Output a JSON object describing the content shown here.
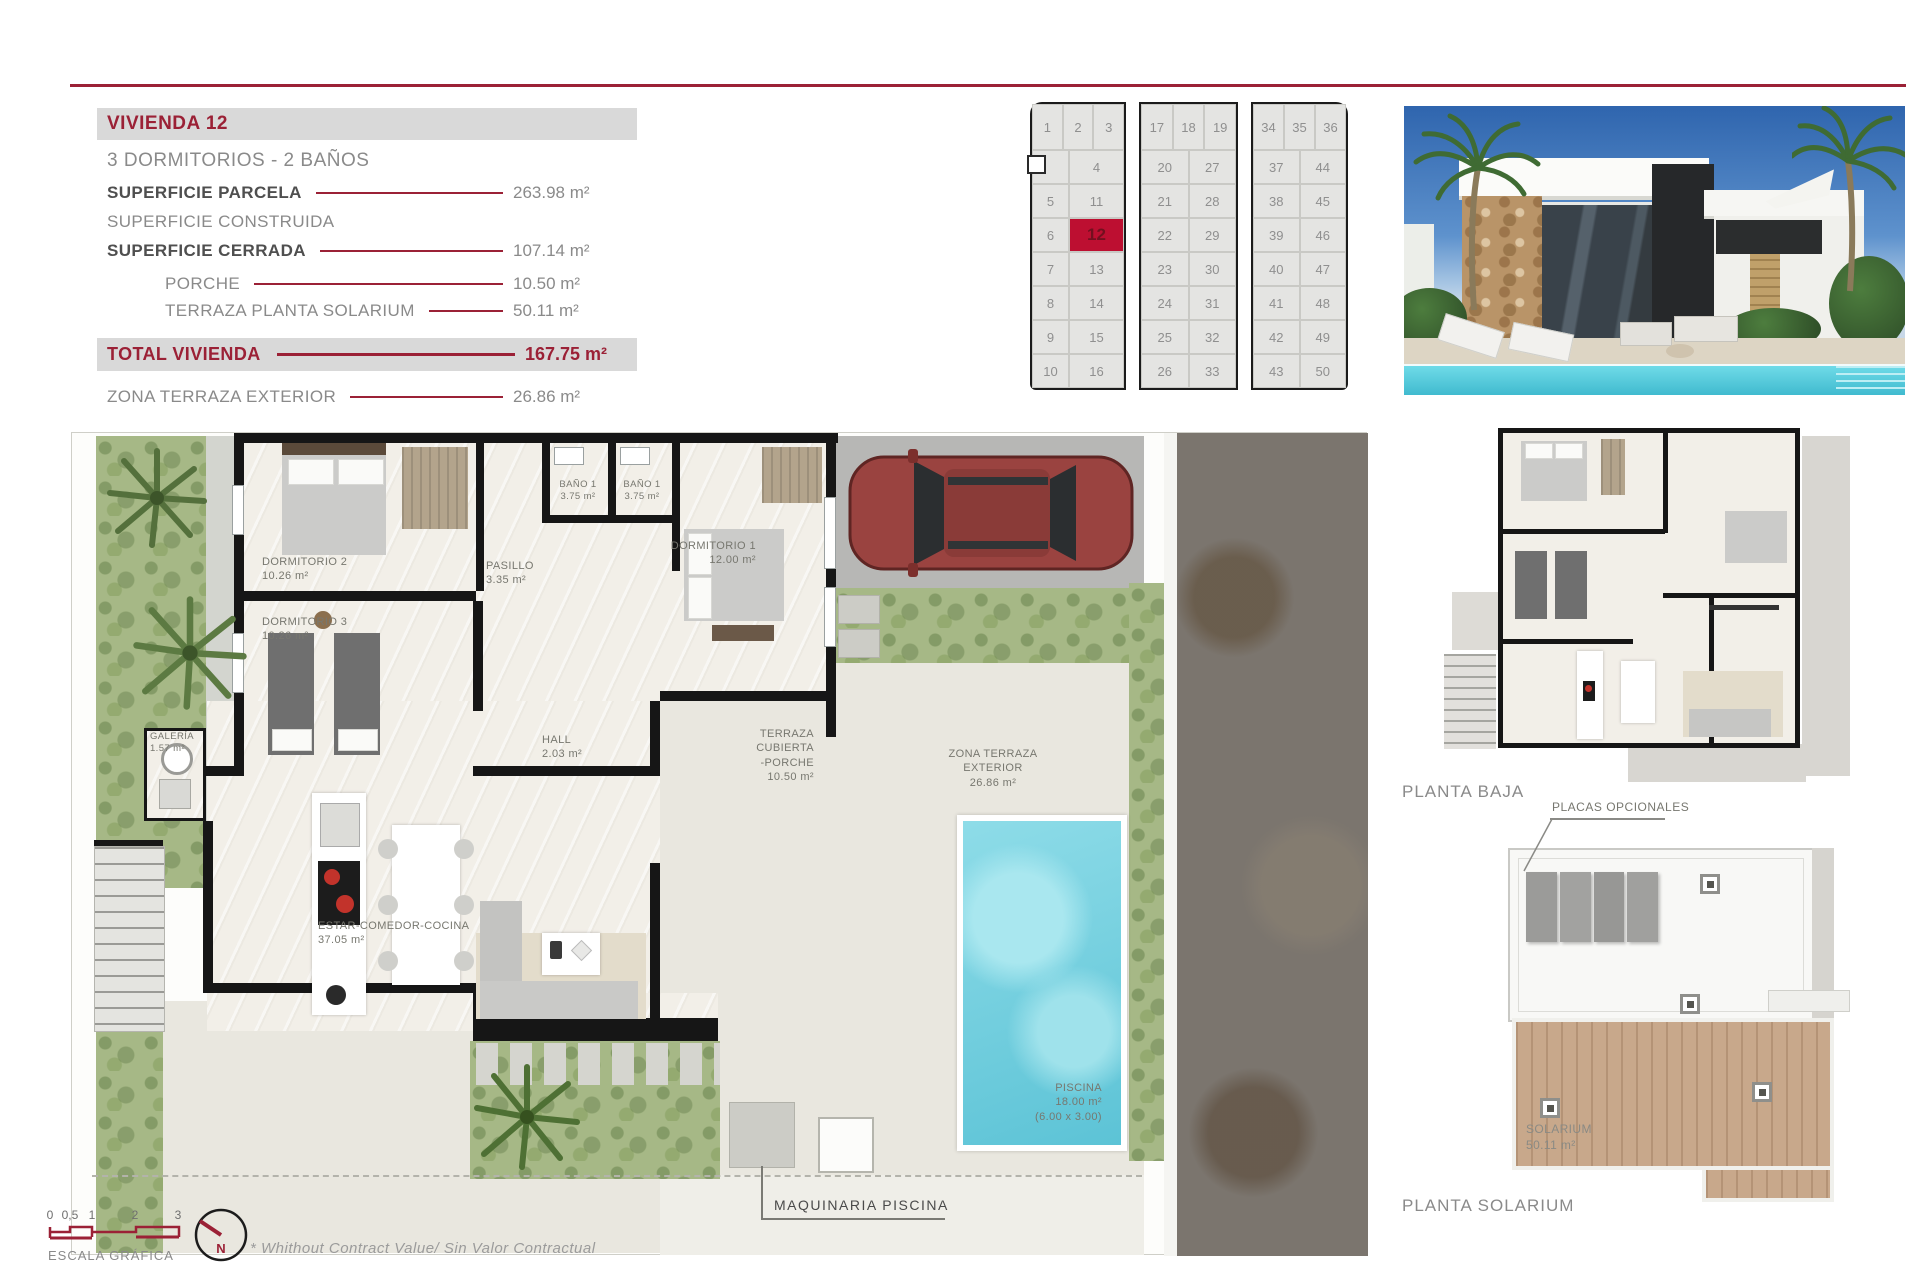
{
  "info": {
    "title": "VIVIENDA 12",
    "subtitle": "3 DORMITORIOS - 2 BAÑOS",
    "rows": {
      "parcela": {
        "label": "SUPERFICIE PARCELA",
        "value": "263.98 m²"
      },
      "construida": {
        "label": "SUPERFICIE CONSTRUIDA",
        "value": ""
      },
      "cerrada": {
        "label": "SUPERFICIE CERRADA",
        "value": "107.14 m²"
      },
      "porche": {
        "label": "PORCHE",
        "value": "10.50 m²"
      },
      "terraza_solarium": {
        "label": "TERRAZA PLANTA SOLARIUM",
        "value": "50.11 m²"
      }
    },
    "total": {
      "label": "TOTAL VIVIENDA",
      "value": "167.75 m²"
    },
    "zona": {
      "label": "ZONA TERRAZA EXTERIOR",
      "value": "26.86 m²"
    }
  },
  "unit_grid": {
    "highlight": "12",
    "blocks": [
      {
        "top": [
          "1",
          "2",
          "3"
        ],
        "rows": [
          [
            "",
            "4"
          ],
          [
            "5",
            "11"
          ],
          [
            "6",
            "12"
          ],
          [
            "7",
            "13"
          ],
          [
            "8",
            "14"
          ],
          [
            "9",
            "15"
          ],
          [
            "10",
            "16"
          ]
        ]
      },
      {
        "top": [
          "17",
          "18",
          "19"
        ],
        "rows": [
          [
            "20",
            "27"
          ],
          [
            "21",
            "28"
          ],
          [
            "22",
            "29"
          ],
          [
            "23",
            "30"
          ],
          [
            "24",
            "31"
          ],
          [
            "25",
            "32"
          ],
          [
            "26",
            "33"
          ]
        ]
      },
      {
        "top": [
          "34",
          "35",
          "36"
        ],
        "rows": [
          [
            "37",
            "44"
          ],
          [
            "38",
            "45"
          ],
          [
            "39",
            "46"
          ],
          [
            "40",
            "47"
          ],
          [
            "41",
            "48"
          ],
          [
            "42",
            "49"
          ],
          [
            "43",
            "50"
          ]
        ]
      }
    ]
  },
  "plan": {
    "rooms": {
      "dormitorio2": {
        "name": "DORMITORIO 2",
        "area": "10.26 m²"
      },
      "dormitorio3": {
        "name": "DORMITORIO 3",
        "area": "10.26 m²"
      },
      "bano1a": {
        "name": "BAÑO 1",
        "area": "3.75 m²"
      },
      "bano1b": {
        "name": "BAÑO 1",
        "area": "3.75 m²"
      },
      "pasillo": {
        "name": "PASILLO",
        "area": "3.35 m²"
      },
      "dormitorio1": {
        "name": "DORMITORIO 1",
        "area": "12.00 m²"
      },
      "galeria": {
        "name": "GALERÍA",
        "area": "1.57 m²"
      },
      "hall": {
        "name": "HALL",
        "area": "2.03 m²"
      },
      "estar": {
        "name": "ESTAR-COMEDOR-COCINA",
        "area": "37.05 m²"
      },
      "terraza_cubierta": {
        "name": "TERRAZA CUBIERTA",
        "name2": "-PORCHE",
        "area": "10.50 m²"
      },
      "zona_terraza": {
        "name": "ZONA TERRAZA EXTERIOR",
        "area": "26.86 m²"
      },
      "piscina": {
        "name": "PISCINA",
        "area": "18.00 m²",
        "dims": "(6.00 x 3.00)"
      }
    },
    "maquinaria": "MAQUINARIA PISCINA"
  },
  "side": {
    "planta_baja": "PLANTA BAJA",
    "placas": "PLACAS OPCIONALES",
    "solarium": {
      "name": "SOLARIUM",
      "area": "50.11 m²"
    },
    "planta_solarium": "PLANTA SOLARIUM"
  },
  "footer": {
    "scale_ticks": [
      "0",
      "0,5",
      "1",
      "2",
      "3"
    ],
    "scale_label": "ESCALA GRÁFICA",
    "north": "N",
    "disclaimer": "*  Whithout Contract Value/ Sin Valor Contractual"
  },
  "colors": {
    "maroon": "#9b2136",
    "red_cell": "#bd0f31"
  }
}
